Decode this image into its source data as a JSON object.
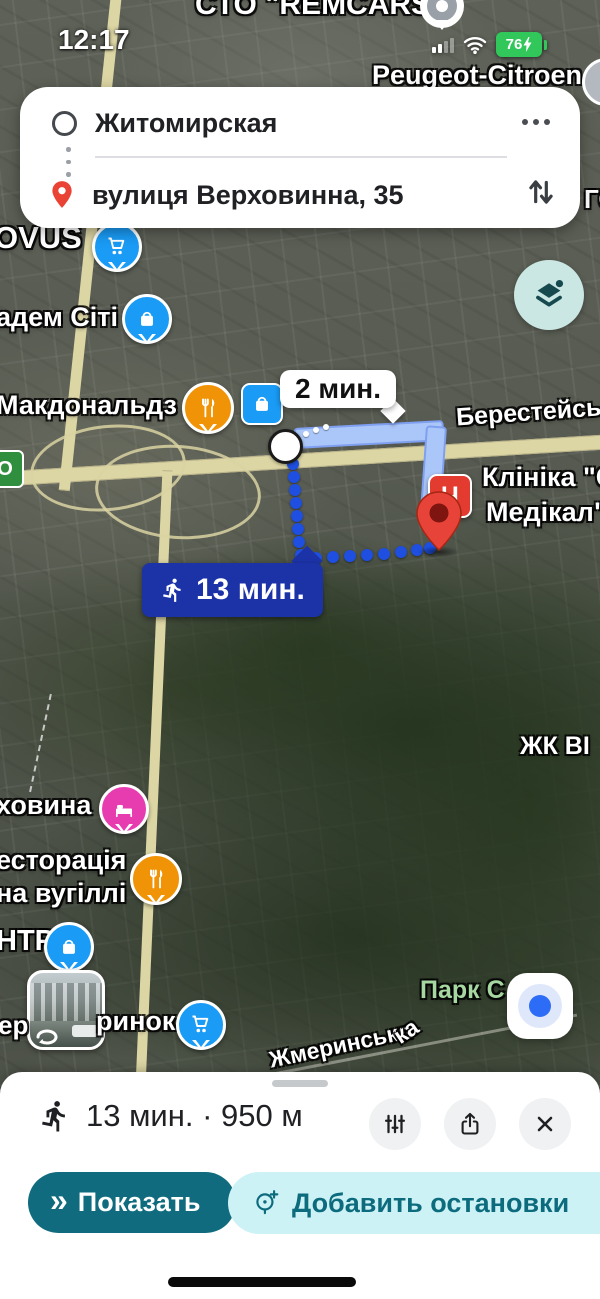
{
  "status_bar": {
    "time": "12:17",
    "battery_percent": "76"
  },
  "route_card": {
    "origin_value": "Житомирская",
    "destination_value": "вулиця Верховинна, 35"
  },
  "route_overlay": {
    "drive_time": "2 мин.",
    "walk_time": "13 мин."
  },
  "map_labels": {
    "sto_remcars": "СТО \"REMCARS\"",
    "peugeot_citroen": "Peugeot-Citroen",
    "partial_go": "ГО",
    "novus": "OVUS",
    "akadem": "адем Сіті",
    "mcdonalds": "Макдональдз",
    "beresteiska": "Берестейськ",
    "clinic_line1": "Клініка \"С",
    "clinic_line2": "Медікал\"",
    "clinic_marker_letter": "Ч",
    "zhk": "ЖК ВІ",
    "hovyna": "ховина",
    "restaurant_line1": "есторація",
    "restaurant_line2": "на вугіллі",
    "ntr": "НТР",
    "er": "ер",
    "rynok": "ринок",
    "park": "Парк С",
    "zhmerynska": "Жмеринська",
    "ka": "ка",
    "road_shield": "О"
  },
  "bottom_sheet": {
    "summary": "13 мин. · 950 м",
    "show_label": "Показать",
    "add_stops_label": "Добавить остановки"
  },
  "colors": {
    "accent_teal": "#0f6b7d",
    "walk_label_blue": "#1c33a8",
    "route_ribbon_blue": "#abc6f8",
    "battery_green": "#32c75a",
    "destination_pin_red": "#e84338",
    "poi_blue": "#1a9bf5",
    "poi_orange": "#f09307",
    "poi_pink": "#e73cb0"
  }
}
